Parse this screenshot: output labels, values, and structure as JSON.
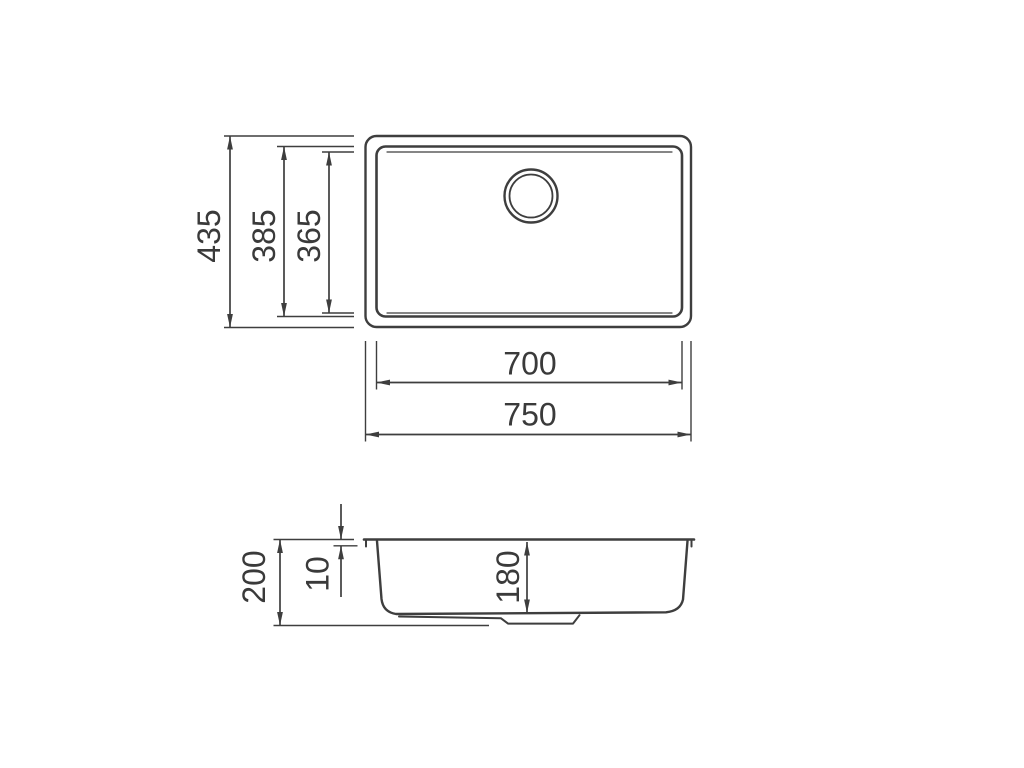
{
  "colors": {
    "background": "#ffffff",
    "line": "#3e3e3e",
    "text": "#3a3a3a"
  },
  "top_view": {
    "overall_height_mm": "435",
    "bowl_outer_height_mm": "385",
    "bowl_inner_height_mm": "365",
    "bowl_width_mm": "700",
    "overall_width_mm": "750"
  },
  "side_view": {
    "overall_depth_mm": "200",
    "rim_height_mm": "10",
    "bowl_depth_mm": "180"
  }
}
